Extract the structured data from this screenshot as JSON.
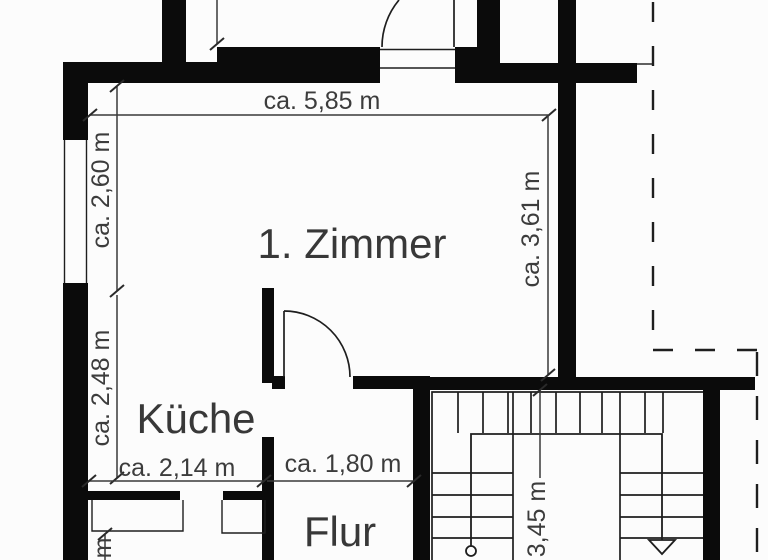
{
  "plan": {
    "rooms": {
      "zimmer": "1. Zimmer",
      "kueche": "Küche",
      "flur": "Flur"
    },
    "dimensions": {
      "top_width": "ca. 5,85 m",
      "left_upper_height": "ca. 2,60 m",
      "left_lower_height": "ca. 2,48 m",
      "kitchen_width": "ca. 2,14 m",
      "hall_width": "ca. 1,80 m",
      "right_height": "ca. 3,61 m",
      "stair_height": "3,45 m",
      "cutoff_bottom": "m"
    },
    "colors": {
      "wall": "#0b0b0b",
      "line": "#1e1e1e",
      "dimension_text": "#3c3c3c",
      "background": "#fcfcfc"
    }
  }
}
